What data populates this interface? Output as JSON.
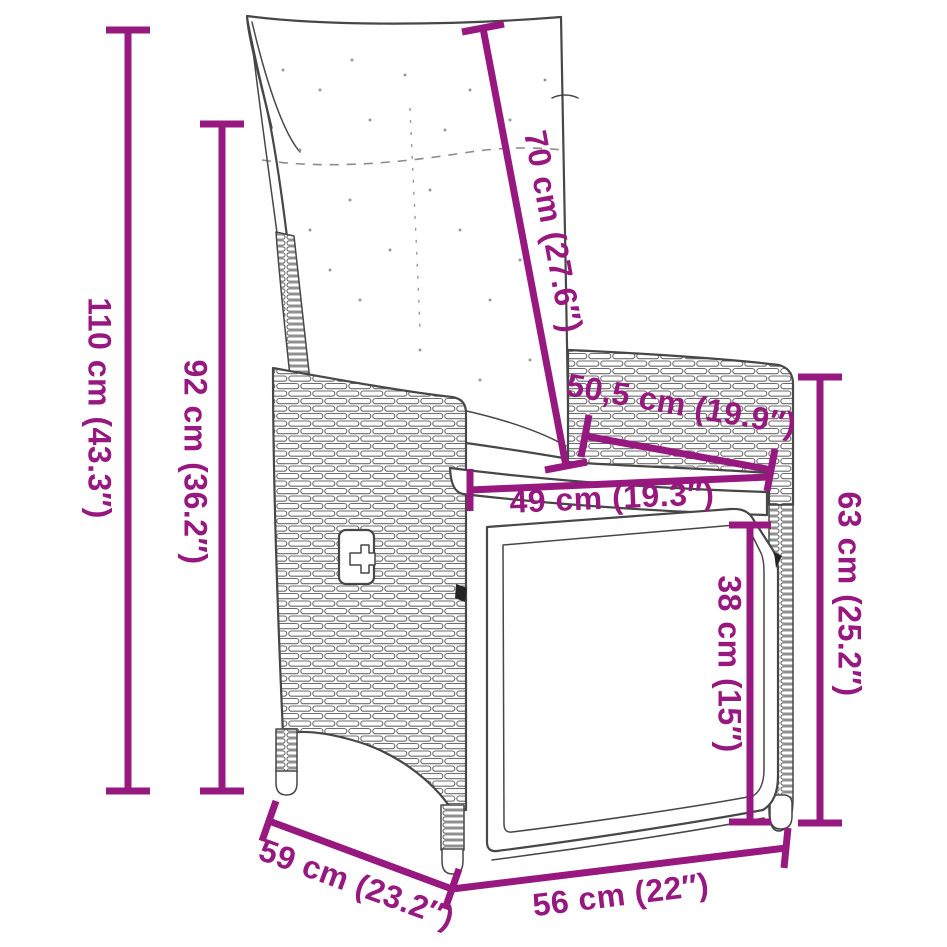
{
  "diagram": {
    "illustration": "reclining-garden-chair-line-art",
    "colors": {
      "dimension": "#97187F",
      "artwork": "#474747",
      "background": "#ffffff"
    },
    "dimensions": [
      {
        "id": "overall-height",
        "label": "110 cm (43.3″)"
      },
      {
        "id": "back-height",
        "label": "92 cm (36.2″)"
      },
      {
        "id": "backrest-length",
        "label": "70 cm (27.6″)"
      },
      {
        "id": "armrest-length",
        "label": "50,5 cm (19.9″)"
      },
      {
        "id": "seat-width",
        "label": "49 cm (19.3″)"
      },
      {
        "id": "armrest-height",
        "label": "63 cm (25.2″)"
      },
      {
        "id": "seat-height",
        "label": "38 cm (15″)"
      },
      {
        "id": "seat-depth",
        "label": "59 cm (23.2″)"
      },
      {
        "id": "base-width",
        "label": "56 cm (22″)"
      }
    ]
  }
}
